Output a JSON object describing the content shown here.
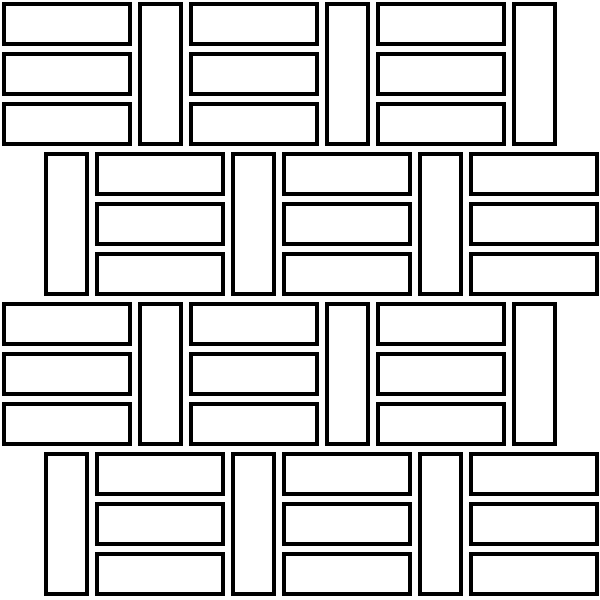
{
  "canvas": {
    "width": 600,
    "height": 600,
    "background_color": "#ffffff"
  },
  "pattern": {
    "type": "basketweave-3-brick-mosaic",
    "description": "black outlined white bricks: stacks of 3 horizontal bricks alternating with single vertical bricks; alternate rows offset",
    "brick_border_color": "#000000",
    "brick_fill_color": "#ffffff",
    "border_thickness": 4,
    "horizontal_brick": {
      "width": 130,
      "height": 44
    },
    "vertical_brick": {
      "width": 45,
      "height": 144
    },
    "brick_gap": 6,
    "stack_step": 50,
    "bricks_per_stack": 3,
    "units_per_row": 3,
    "rows": [
      {
        "y": 2,
        "start_x": 2,
        "sequence": [
          "stack",
          "vertical"
        ]
      },
      {
        "y": 152,
        "start_x": 44,
        "sequence": [
          "vertical",
          "stack"
        ]
      },
      {
        "y": 302,
        "start_x": 2,
        "sequence": [
          "stack",
          "vertical"
        ]
      },
      {
        "y": 452,
        "start_x": 44,
        "sequence": [
          "vertical",
          "stack"
        ]
      }
    ]
  }
}
